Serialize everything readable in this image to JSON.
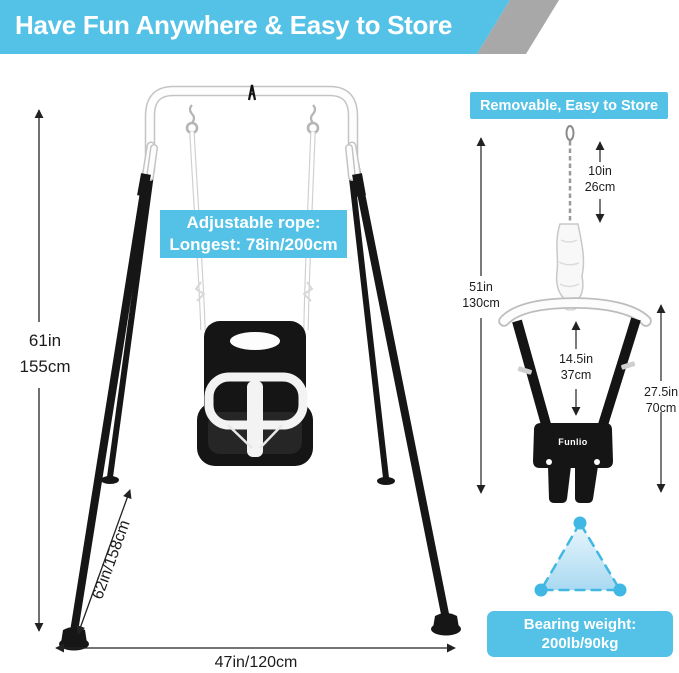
{
  "banner": {
    "title": "Have Fun Anywhere & Easy to Store"
  },
  "swing_diagram": {
    "rope_label": {
      "line1": "Adjustable rope:",
      "line2": "Longest: 78in/200cm"
    },
    "height": {
      "inches": "61in",
      "cm": "155cm"
    },
    "leg_length": "62in/158cm",
    "base_width": "47in/120cm"
  },
  "jumper_panel": {
    "header": "Removable, Easy to Store",
    "brand": "Funlio",
    "chain": {
      "inches": "10in",
      "cm": "26cm"
    },
    "total_height": {
      "inches": "51in",
      "cm": "130cm"
    },
    "strap_drop": {
      "inches": "14.5in",
      "cm": "37cm"
    },
    "side_height": {
      "inches": "27.5in",
      "cm": "70cm"
    },
    "bearing": {
      "line1": "Bearing weight:",
      "line2": "200lb/90kg"
    }
  },
  "colors": {
    "accent": "#54C2E7",
    "banner_gray": "#A8A8A8",
    "triangle_stroke": "#41B8E4",
    "frame_black": "#161616",
    "dim_text": "#1c1c1c"
  }
}
